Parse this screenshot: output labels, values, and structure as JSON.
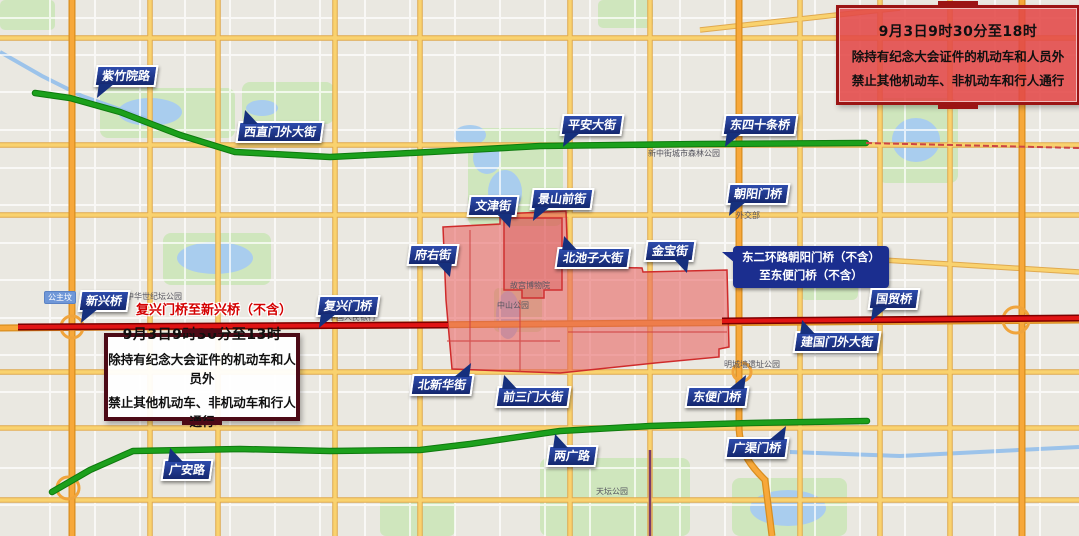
{
  "notices": {
    "evening": {
      "line1": "9月3日9时30分至18时",
      "line2": "除持有纪念大会证件的机动车和人员外",
      "line3": "禁止其他机动车、非机动车和行人通行"
    },
    "noon": {
      "line1": "9月3日9时30分至13时",
      "line2": "除持有纪念大会证件的机动车和人员外",
      "line3": "禁止其他机动车、非机动车和行人通行"
    }
  },
  "road_labels": [
    {
      "text": "紫竹院路"
    },
    {
      "text": "西直门外大街"
    },
    {
      "text": "平安大街"
    },
    {
      "text": "东四十条桥"
    },
    {
      "text": "文津街"
    },
    {
      "text": "景山前街"
    },
    {
      "text": "朝阳门桥"
    },
    {
      "text": "府右街"
    },
    {
      "text": "北池子大街"
    },
    {
      "text": "金宝街"
    },
    {
      "text": "新兴桥"
    },
    {
      "text": "复兴门桥"
    },
    {
      "text": "国贸桥"
    },
    {
      "text": "建国门外大街"
    },
    {
      "text": "北新华街"
    },
    {
      "text": "前三门大街"
    },
    {
      "text": "东便门桥"
    },
    {
      "text": "两广路"
    },
    {
      "text": "广渠门桥"
    },
    {
      "text": "广安路"
    }
  ],
  "section_labels": {
    "red_inline": {
      "text": "复兴门桥至新兴桥（不含）"
    },
    "blue_box": {
      "line1": "东二环路朝阳门桥（不含）",
      "line2": "至东便门桥（不含）"
    }
  },
  "poi_labels": [
    {
      "text": "中华世纪坛公园"
    },
    {
      "text": "中国人民银行"
    },
    {
      "text": "故宫博物院"
    },
    {
      "text": "中山公园"
    },
    {
      "text": "天坛公园"
    },
    {
      "text": "明城墙遗址公园"
    },
    {
      "text": "新中街城市森林公园"
    },
    {
      "text": "外交部"
    },
    {
      "text": "公主坟"
    }
  ],
  "colors": {
    "route_green": "#189a18",
    "route_red": "#d61414",
    "restricted_zone_fill": "#e85a5a",
    "restricted_zone_border": "#cf2b2b",
    "ribbon_navy": "#16307d",
    "notice_red_bg": "#e24848",
    "notice_red_border": "#9b1414",
    "notice_dark_border": "#4c0a16",
    "highway_orange": "#f7a83a",
    "arterial_yellow": "#f9d26f",
    "water_blue": "#a9cdee",
    "park_green": "#cfe6bd"
  }
}
